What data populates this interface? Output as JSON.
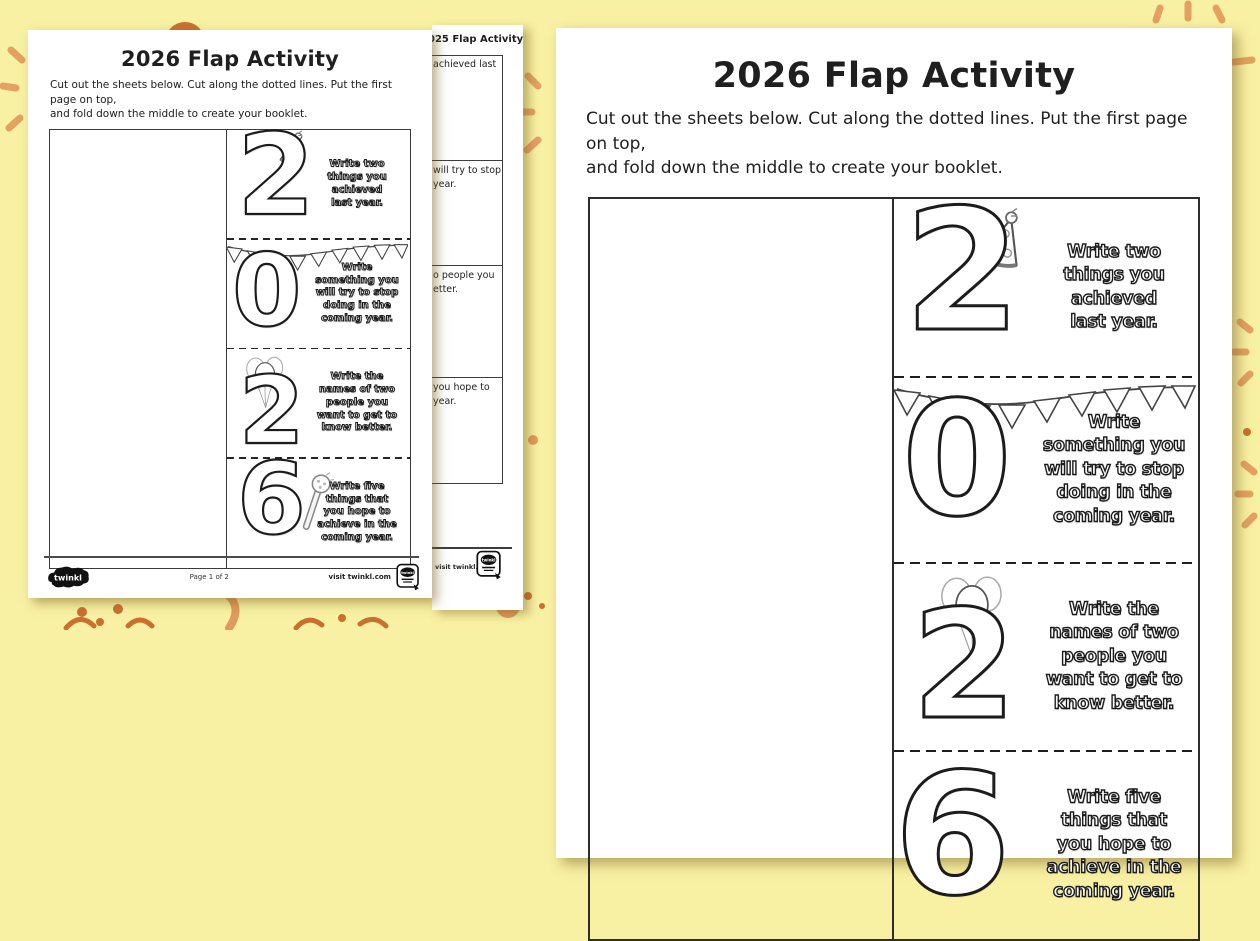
{
  "colors": {
    "background": "#F8F0A2",
    "decoration_orange": "#E2995B",
    "decoration_dark_orange": "#C9702F",
    "paper": "#FFFFFF",
    "ink": "#1F1F1F"
  },
  "worksheet": {
    "title": "2026 Flap Activity",
    "instructions": [
      "Cut out the sheets below. Cut along the dotted lines. Put the first page on top,",
      "and fold down the middle to create your booklet."
    ],
    "flaps": [
      {
        "numeral": "2",
        "icon": "party-hat",
        "text": "Write two things you achieved last year.",
        "lines": [
          "Write two",
          "things you",
          "achieved",
          "last year."
        ]
      },
      {
        "numeral": "0",
        "icon": "bunting",
        "text": "Write something you will try to stop doing in the coming year.",
        "lines": [
          "Write",
          "something you",
          "will try to stop",
          "doing in the",
          "coming year."
        ]
      },
      {
        "numeral": "2",
        "icon": "balloons",
        "text": "Write the names of two people you want to get to know better.",
        "lines": [
          "Write the",
          "names of two",
          "people you",
          "want to get to",
          "know better."
        ]
      },
      {
        "numeral": "6",
        "icon": "party-popper",
        "text": "Write five things that you hope to achieve in the coming year.",
        "lines": [
          "Write five",
          "things that",
          "you hope to",
          "achieve in the",
          "coming year."
        ]
      }
    ],
    "footer": {
      "logo": "twinkl",
      "page_indicator": "Page 1 of 2",
      "visit": "visit twinkl.com",
      "badge_label": "twinkl"
    }
  },
  "back_page": {
    "title_fragment": "025 Flap Activity",
    "fragments": [
      [
        "achieved last"
      ],
      [
        "will try to stop",
        "year."
      ],
      [
        "o people you",
        "etter."
      ],
      [
        "you hope to",
        "year."
      ]
    ],
    "visit": "visit twinkl.com",
    "badge_label": "twinkl"
  }
}
